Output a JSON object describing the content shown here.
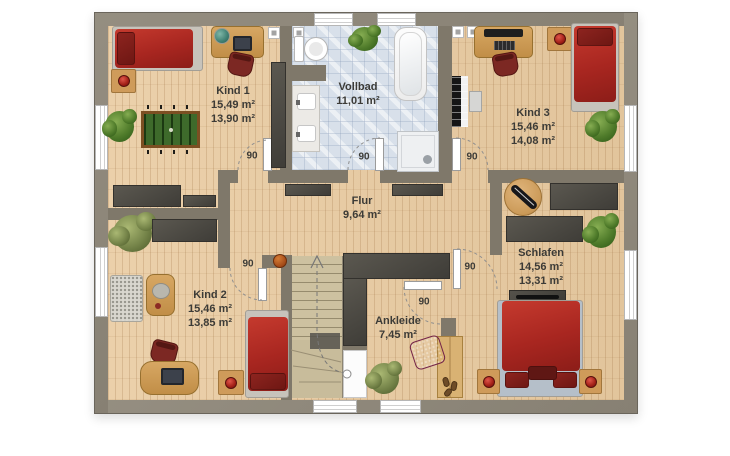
{
  "plan": {
    "rooms": [
      {
        "key": "kind1",
        "name": "Kind 1",
        "areas": [
          "15,49 m²",
          "13,90 m²"
        ],
        "items": [
          "single-bed",
          "nightstand-with-lamp",
          "desk",
          "globe",
          "laptop",
          "desk-chair",
          "foosball-table",
          "plant",
          "wardrobe",
          "radiator"
        ]
      },
      {
        "key": "vollbad",
        "name": "Vollbad",
        "areas": [
          "11,01 m²"
        ],
        "items": [
          "toilet",
          "bathtub",
          "double-washbasin",
          "shower",
          "plant",
          "radiator"
        ]
      },
      {
        "key": "kind3",
        "name": "Kind 3",
        "areas": [
          "15,46 m²",
          "14,08 m²"
        ],
        "items": [
          "desk",
          "monitor",
          "keyboard",
          "desk-chair",
          "single-bed",
          "nightstand-with-lamp",
          "piano-keyboard",
          "piano-bench",
          "plant",
          "side-table-with-skateboard",
          "radiator"
        ]
      },
      {
        "key": "flur",
        "name": "Flur",
        "areas": [
          "9,64 m²"
        ],
        "items": [
          "sideboard",
          "sideboard",
          "basketball",
          "staircase"
        ]
      },
      {
        "key": "kind2",
        "name": "Kind 2",
        "areas": [
          "15,46 m²",
          "13,85 m²"
        ],
        "items": [
          "lounge-sofa",
          "coffee-table",
          "desk",
          "laptop",
          "desk-chair",
          "single-bed",
          "nightstand-with-lamp",
          "plant",
          "wardrobe"
        ]
      },
      {
        "key": "ankleide",
        "name": "Ankleide",
        "areas": [
          "7,45 m²"
        ],
        "items": [
          "wardrobe-l-shaped",
          "wooden-closet",
          "ottoman",
          "plant",
          "shoes"
        ]
      },
      {
        "key": "schlafen",
        "name": "Schlafen",
        "areas": [
          "14,56 m²",
          "13,31 m²"
        ],
        "items": [
          "double-bed",
          "nightstand-with-lamp",
          "nightstand-with-lamp",
          "tv-lowboard",
          "wardrobe",
          "wardrobe",
          "plant"
        ]
      }
    ],
    "door_width_labels": [
      "90",
      "90",
      "90",
      "90",
      "90",
      "90"
    ],
    "colors": {
      "exterior_wall": "#8e8779",
      "interior_wall": "#7f786a",
      "wood_floor": "#e9cba1",
      "bathroom_tile": "#d8e0ea",
      "stairs": "#ccc09f",
      "dark_furniture": "#4a4742",
      "bed_red": "#a82620",
      "wood_furniture": "#cf9b5a",
      "label_text": "#3c3b37",
      "background": "#ffffff"
    }
  }
}
